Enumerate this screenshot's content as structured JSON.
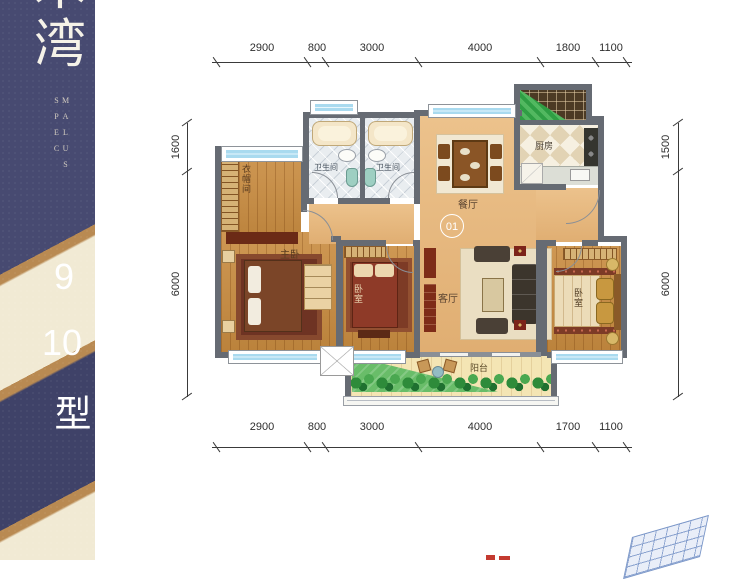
{
  "sidebar": {
    "logo_top": "木",
    "logo": "湾",
    "brand": "MALUS SPEC",
    "num1": "9",
    "num2": "10",
    "building": "栋户型"
  },
  "dims": {
    "top": [
      "2900",
      "800",
      "3000",
      "4000",
      "1800",
      "1100"
    ],
    "bottom": [
      "2900",
      "800",
      "3000",
      "4000",
      "1700",
      "1100"
    ],
    "left": [
      "1600",
      "6000"
    ],
    "right": [
      "1500",
      "6000"
    ]
  },
  "rooms": {
    "cloakroom": "衣帽间",
    "master_bedroom": "主卧",
    "bathroom_left": "卫生间",
    "bathroom_right": "卫生间",
    "dining": "餐厅",
    "kitchen": "厨房",
    "living": "客厅",
    "bedroom_mid": "卧室",
    "bedroom_right": "卧室",
    "balcony": "阳台",
    "unit_number": "01"
  },
  "colors": {
    "sidebar_navy": "#474a71",
    "sidebar_cream": "#f1ead4",
    "sidebar_tan": "#b98a52",
    "wood_floor": "#c98c40",
    "open_floor_tan": "#e5b77d",
    "window_blue": "#a9daef",
    "wall_gray": "#666b73",
    "lawn_green": "#69bd69",
    "rug_red": "#7d3b26"
  }
}
